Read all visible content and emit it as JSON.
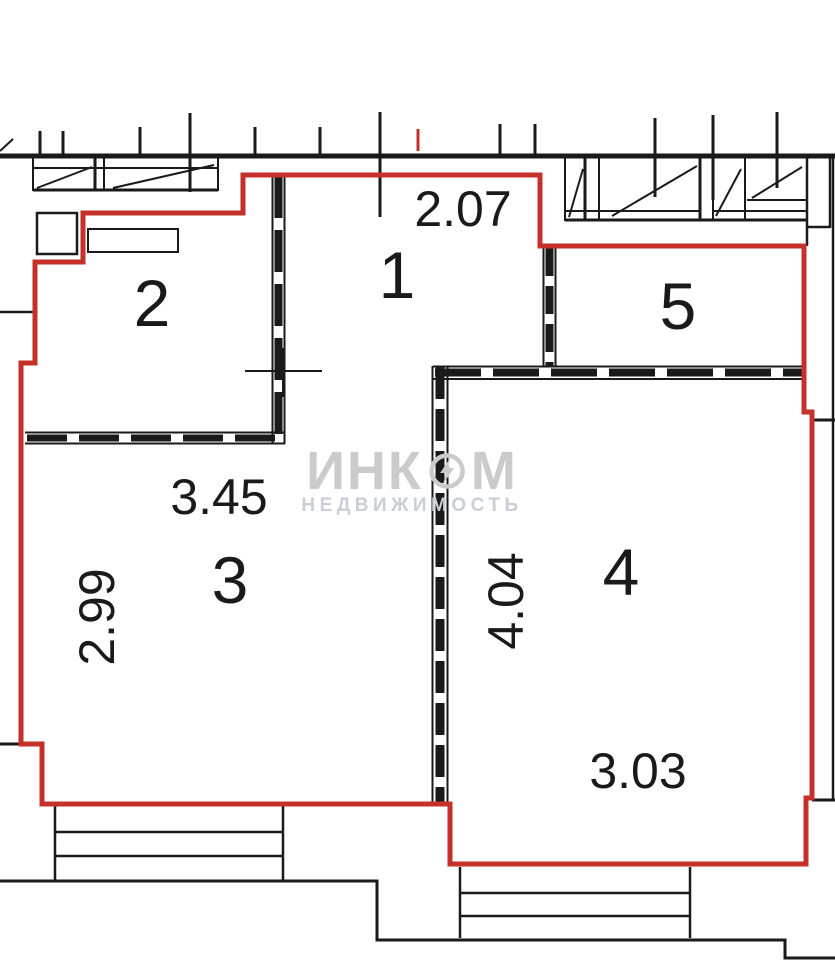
{
  "plan_title": "apartment-floor-plan",
  "rooms": [
    {
      "number": "1"
    },
    {
      "number": "2"
    },
    {
      "number": "3"
    },
    {
      "number": "4"
    },
    {
      "number": "5"
    }
  ],
  "dimensions": {
    "room1_width": "2.07",
    "room3_width": "3.45",
    "room3_depth": "2.99",
    "room4_depth": "4.04",
    "room4_width": "3.03"
  },
  "watermark": {
    "brand_left": "ИНК",
    "brand_right": "М",
    "subtitle": "НЕДВИЖИМОСТЬ"
  },
  "colors": {
    "boundary_red": "#c5302a",
    "wall_black": "#1a1a1a",
    "watermark_gray": "#cbcbcb"
  }
}
